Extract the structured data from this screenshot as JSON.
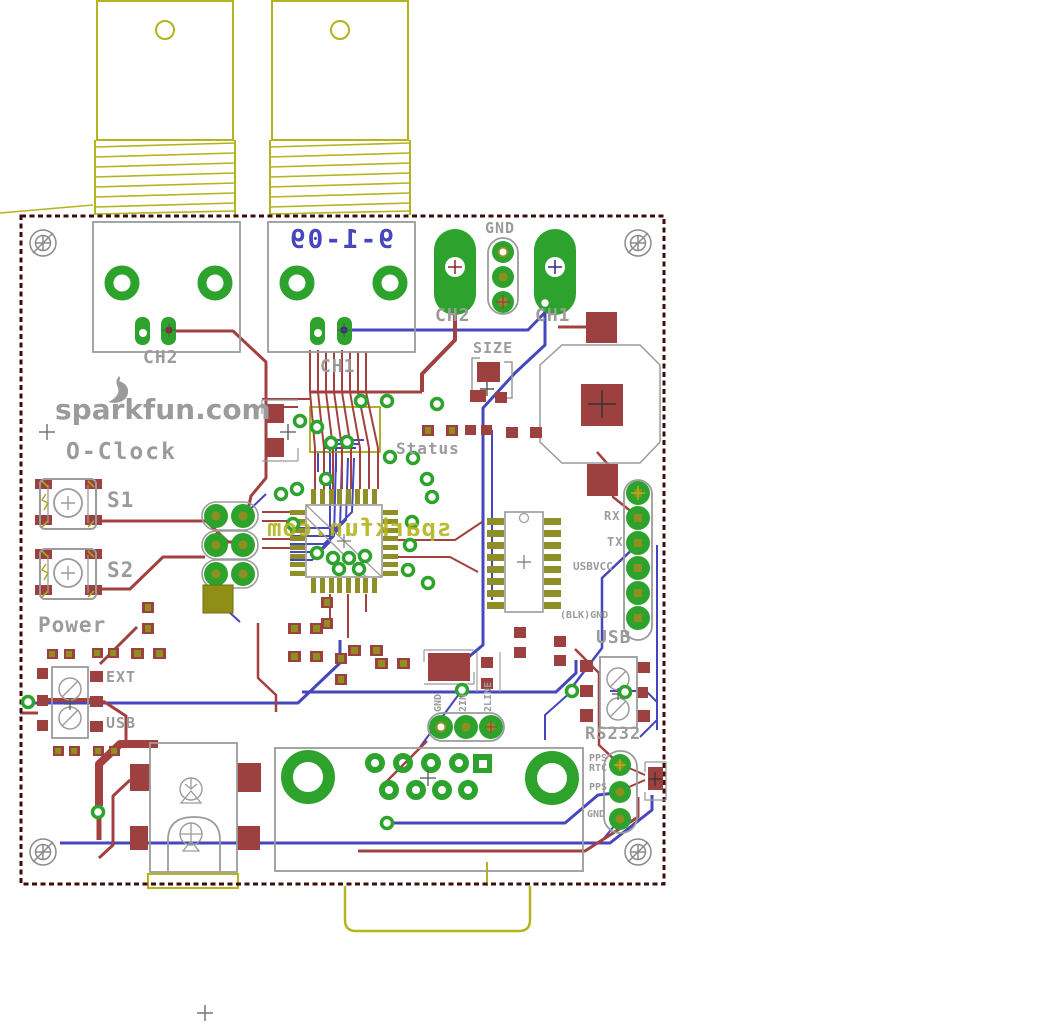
{
  "app": {
    "type": "pcb-board-layout",
    "description": "EAGLE-style PCB layout of SparkFun O-Clock board"
  },
  "board": {
    "brand": "sparkfun.com",
    "product": "O-Clock",
    "date_mirrored": "9-1-09",
    "bottom_copper_brand_mirrored": "sparkfun.com"
  },
  "labels": {
    "gnd_top": "GND",
    "bnc_ch2": "CH2",
    "bnc_ch1": "CH1",
    "pad_ch2": "CH2",
    "pad_ch1": "CH1",
    "size": "SIZE",
    "status": "Status",
    "s1": "S1",
    "s2": "S2",
    "power": "Power",
    "ext": "EXT",
    "usb_power": "USB",
    "rx": "RX",
    "tx": "TX",
    "usbvcc": "USBVCC",
    "blk_gnd": "(BLK)GND",
    "usb_right": "USB",
    "rs232": "RS232",
    "pps": "PPS",
    "rtc": "RTC",
    "pps2": "PPS",
    "gnd_rs232": "GND",
    "gnd_bottom": "GND",
    "in2": "2IN",
    "line2": "2LINE"
  },
  "colors": {
    "top_copper": "#a34040",
    "bottom_copper": "#4646bd",
    "pads_green": "#2da32d",
    "pads_gold": "#8f8f20",
    "silkscreen": "#9b9b9b",
    "bottom_silk_yellow": "#b4b41e",
    "board_outline": "#3f0c0c",
    "background": "#ffffff"
  }
}
